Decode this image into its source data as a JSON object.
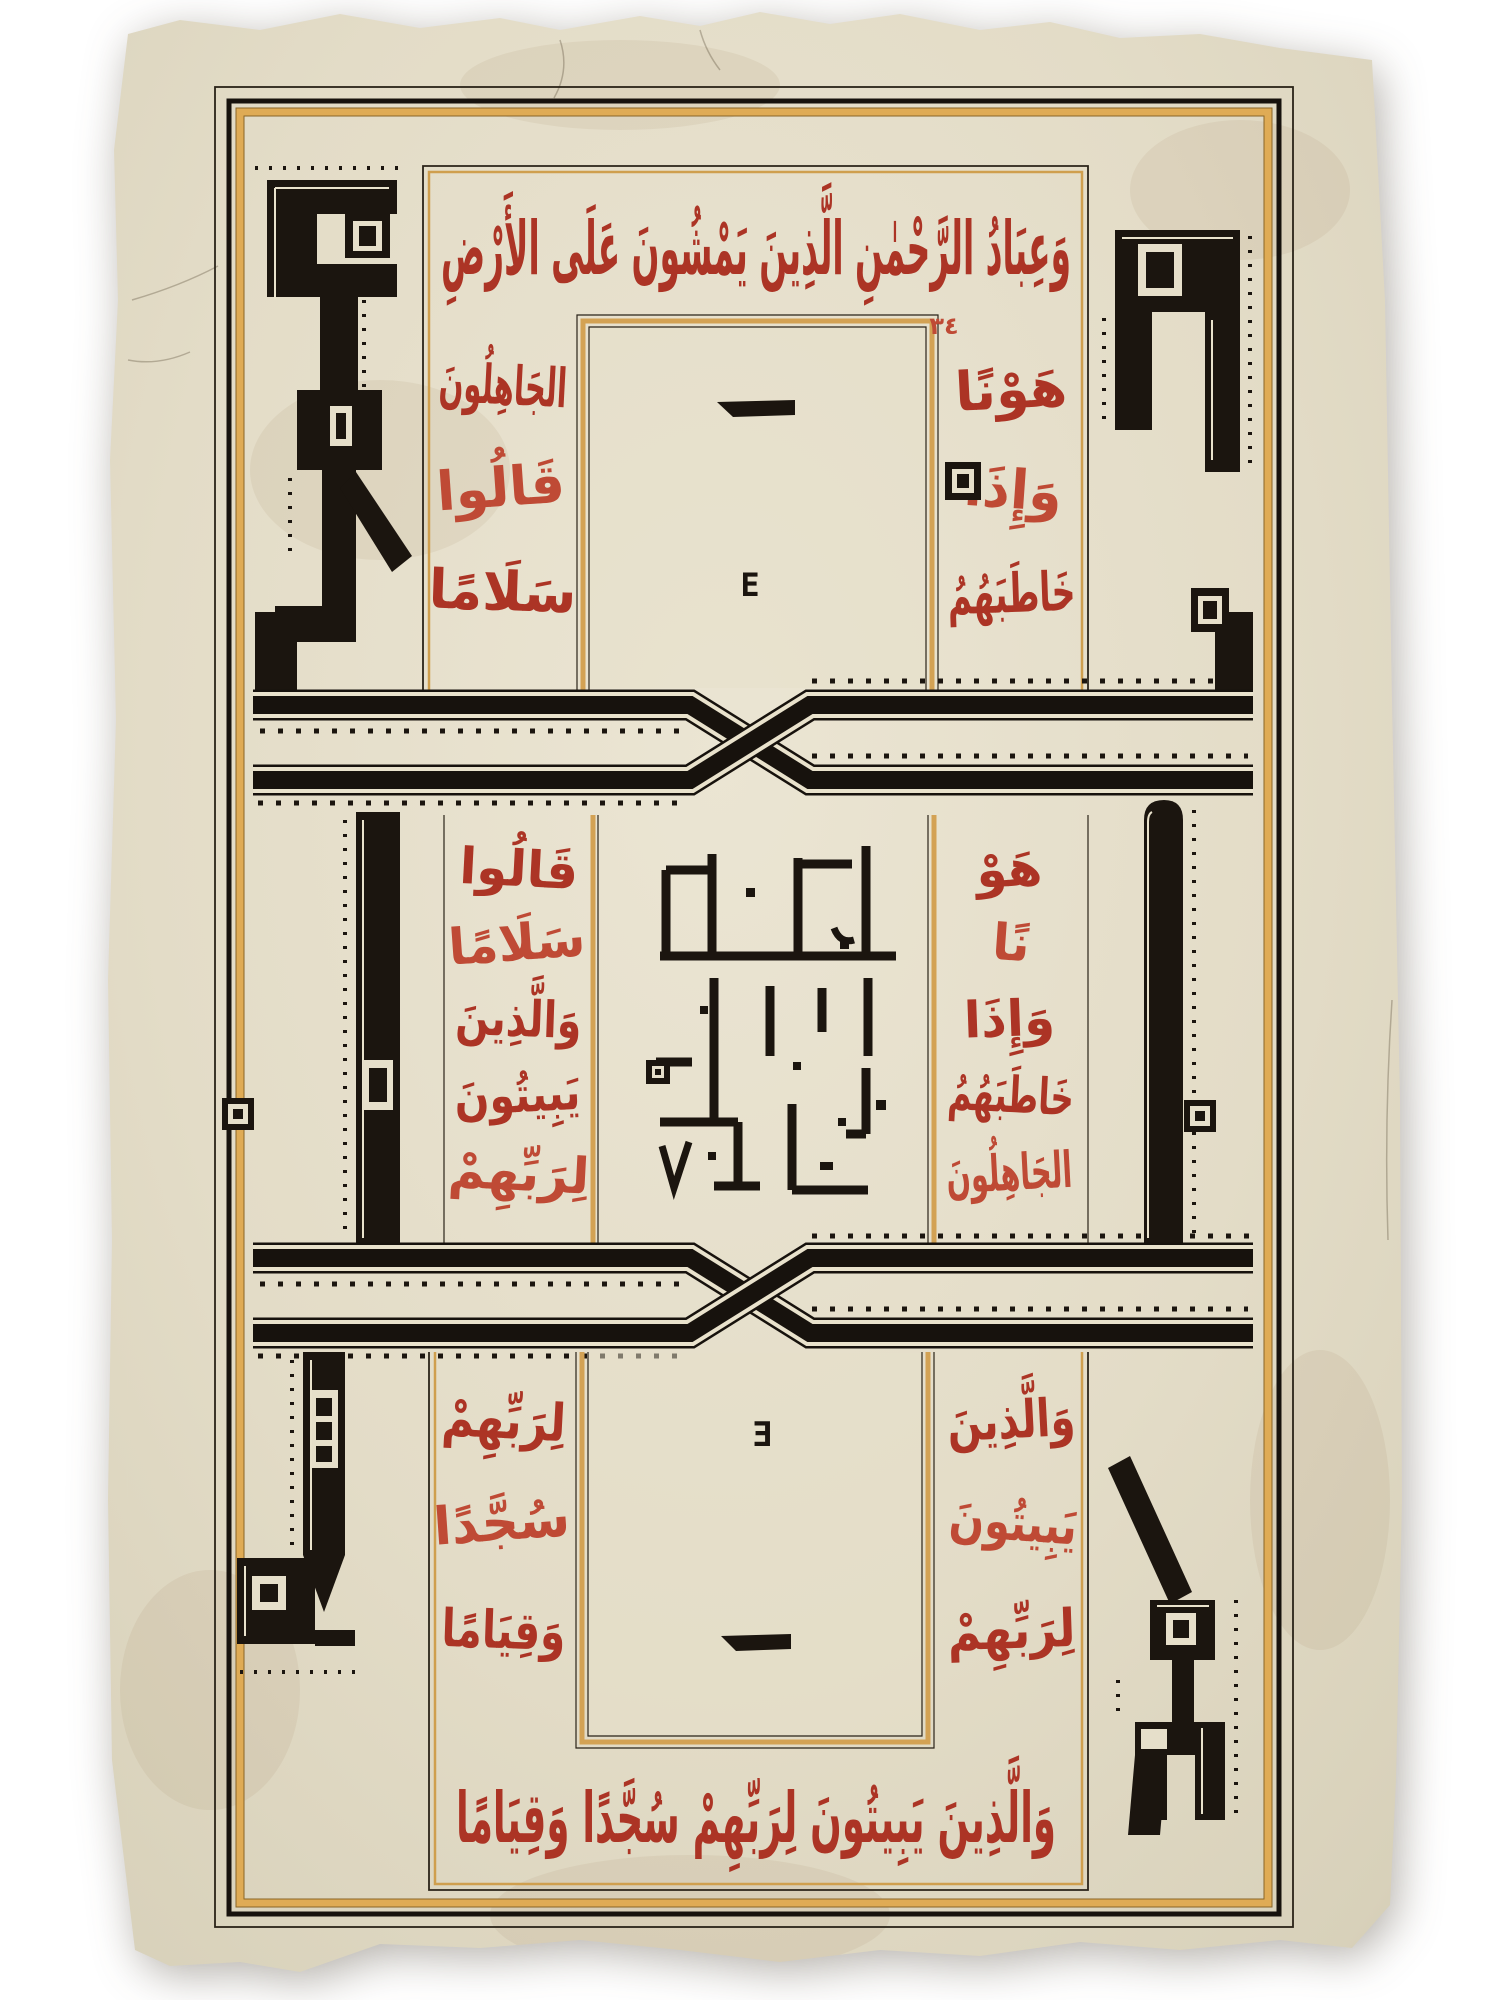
{
  "artwork": {
    "description": "Ottoman manuscript leaf: black square-Kufic composition with red thuluth Quranic borders",
    "colors": {
      "background": "#ffffff",
      "paper": "#e3dcc7",
      "ink_black": "#1b150f",
      "script_red": "#ac3425",
      "ruling_gold": "#d3a254"
    },
    "verse_marker": "٣٤",
    "top_ring": {
      "top_band": "وَعِبَادُ الرَّحْمٰنِ الَّذِينَ يَمْشُونَ عَلَى الأَرْضِ",
      "right_column": {
        "lines": [
          "هَوْنًا",
          "وَإِذَا",
          "خَاطَبَهُمُ"
        ]
      },
      "left_column": {
        "lines": [
          "الجَاهِلُونَ",
          "قَالُوا",
          "سَلَامًا"
        ]
      }
    },
    "top_panel": {
      "glyph": "E"
    },
    "middle": {
      "right_column": {
        "lines": [
          "هَوْ",
          "نًا",
          "وَإِذَا",
          "خَاطَبَهُمُ",
          "الجَاهِلُونَ"
        ]
      },
      "left_column": {
        "lines": [
          "قَالُوا",
          "سَلَامًا",
          "وَالَّذِينَ",
          "يَبِيتُونَ",
          "لِرَبِّهِمْ"
        ]
      }
    },
    "bottom_panel": {
      "glyph": "Ǝ"
    },
    "bottom_ring": {
      "right_column": {
        "lines": [
          "وَالَّذِينَ",
          "يَبِيتُونَ",
          "لِرَبِّهِمْ"
        ]
      },
      "left_column": {
        "lines": [
          "لِرَبِّهِمْ",
          "سُجَّدًا",
          "وَقِيَامًا"
        ]
      },
      "bottom_band": "وَالَّذِينَ يَبِيتُونَ لِرَبِّهِمْ سُجَّدًا وَقِيَامًا"
    }
  }
}
